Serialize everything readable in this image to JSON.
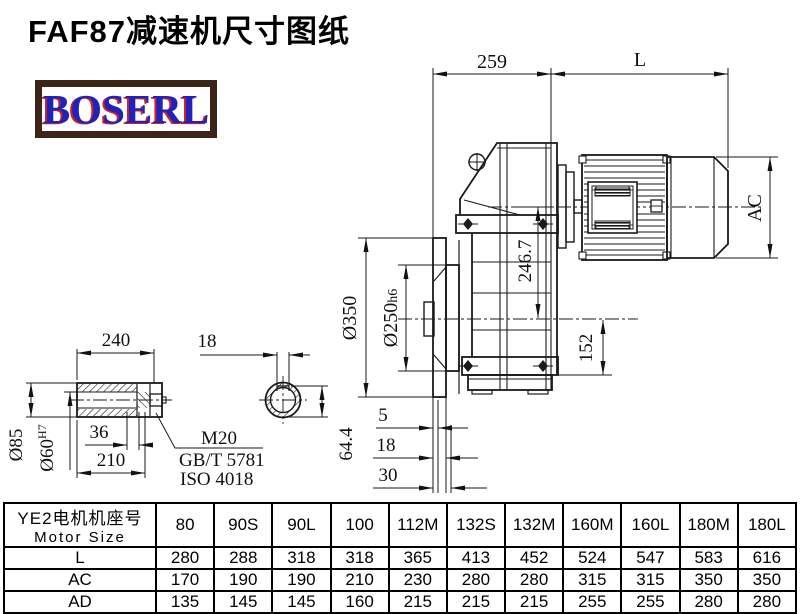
{
  "page": {
    "title": "FAF87减速机尺寸图纸",
    "logo_text": "BOSERL"
  },
  "drawing": {
    "dims": {
      "top_width": "259",
      "motor_length": "L",
      "motor_diameter": "AC",
      "axis_height": "246.7",
      "base_height": "152",
      "flange_diameter": "Ø350",
      "spigot_diameter": "Ø250",
      "spigot_fit": "h6",
      "gap5": "5",
      "gap18": "18",
      "gap30": "30",
      "shaft_length": "240",
      "bolt_depth": "36",
      "bore_depth": "210",
      "shaft_od": "Ø85",
      "bore_d": "Ø60",
      "bore_fit": "H7",
      "keyway_width": "18",
      "keyway_height": "64.4",
      "bolt_label": "M20",
      "bolt_standard": "GB/T 5781",
      "bolt_iso": "ISO 4018"
    }
  },
  "table": {
    "header_cn": "YE2电机机座号",
    "header_en": "Motor Size",
    "columns": [
      "80",
      "90S",
      "90L",
      "100",
      "112M",
      "132S",
      "132M",
      "160M",
      "160L",
      "180M",
      "180L"
    ],
    "rows": [
      {
        "label": "L",
        "values": [
          "280",
          "288",
          "318",
          "318",
          "365",
          "413",
          "452",
          "524",
          "547",
          "583",
          "616"
        ]
      },
      {
        "label": "AC",
        "values": [
          "170",
          "190",
          "190",
          "210",
          "230",
          "280",
          "280",
          "315",
          "315",
          "350",
          "350"
        ]
      },
      {
        "label": "AD",
        "values": [
          "135",
          "145",
          "145",
          "160",
          "215",
          "215",
          "215",
          "255",
          "255",
          "280",
          "280"
        ]
      }
    ]
  },
  "colors": {
    "line": "#1a1a1a",
    "logo_text": "#2222bb",
    "logo_shadow": "#cc2222",
    "logo_border": "#3c2418"
  }
}
